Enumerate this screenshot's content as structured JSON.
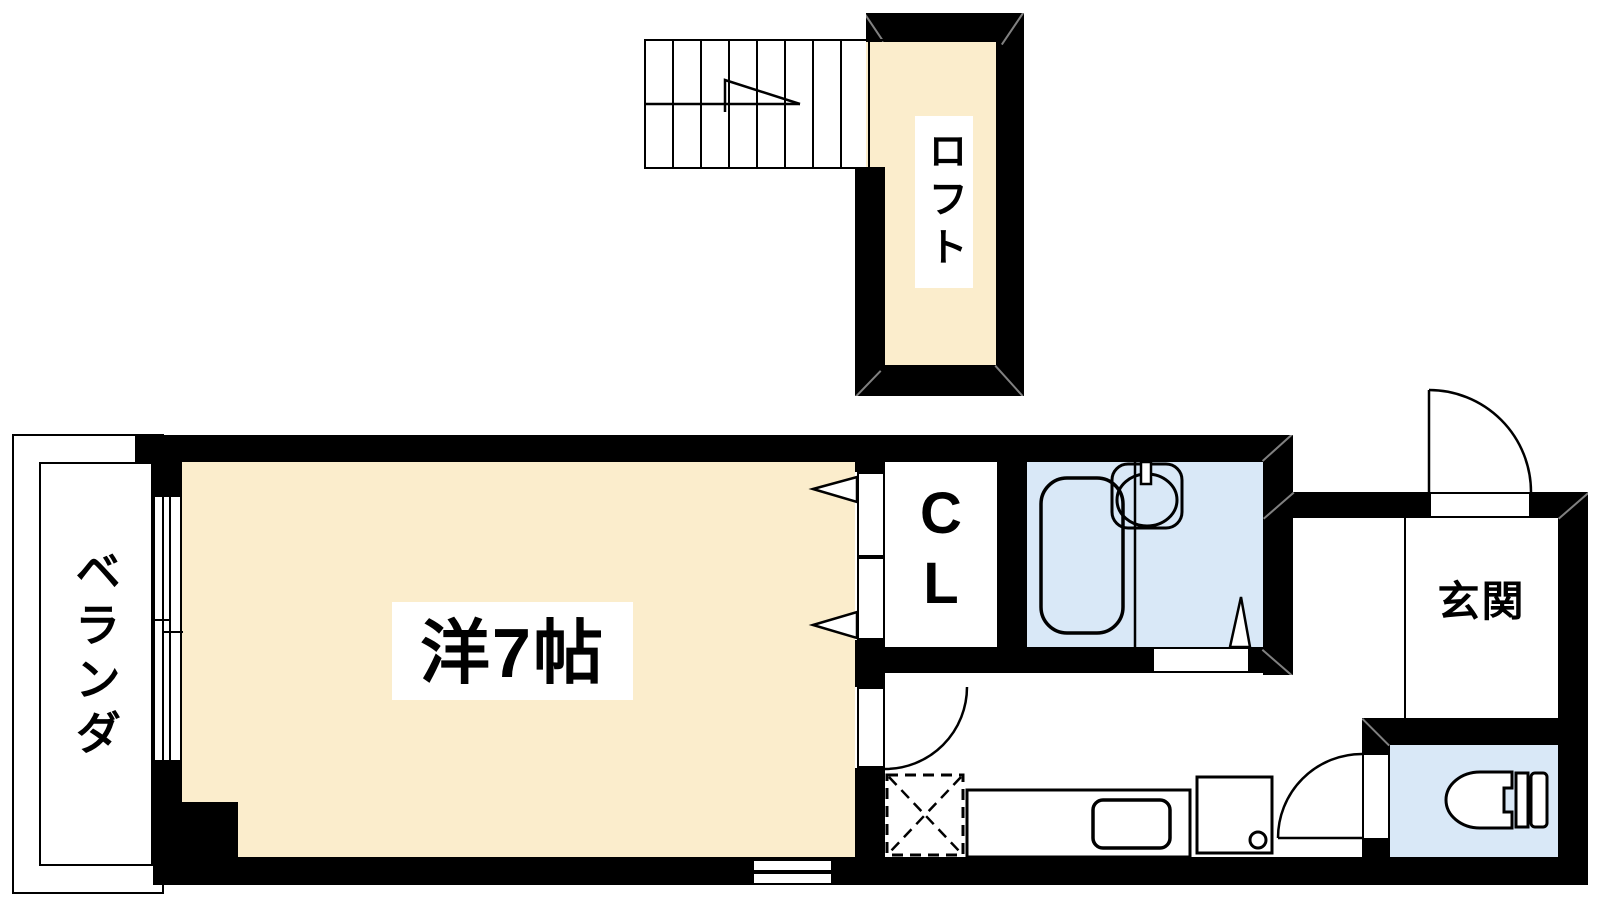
{
  "floorplan": {
    "rooms": {
      "loft": "ロフト",
      "main": "洋7帖",
      "veranda": "ベランダ",
      "closet_letters": [
        "C",
        "L"
      ],
      "entrance": "玄関"
    },
    "colors": {
      "cream": "#FBEDCC",
      "wet": "#D9E8F7",
      "wall": "#000000",
      "bg": "#FFFFFF"
    }
  }
}
